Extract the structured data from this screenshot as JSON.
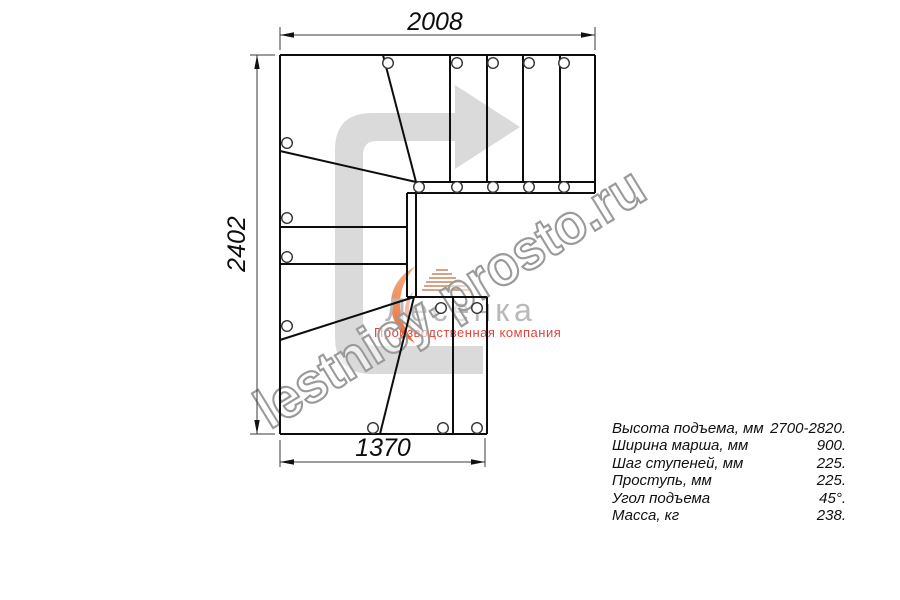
{
  "drawing": {
    "dim_top": "2008",
    "dim_left": "2402",
    "dim_bottom": "1370"
  },
  "watermark": {
    "text": "lestnicy-prosto.ru"
  },
  "logo": {
    "name": "Лесенка",
    "subtitle": "Производственная компания"
  },
  "specs": {
    "rows": [
      {
        "label": "Высота подъема, мм",
        "value": "2700-2820."
      },
      {
        "label": "Ширина марша, мм",
        "value": "900."
      },
      {
        "label": "Шаг ступеней, мм",
        "value": "225."
      },
      {
        "label": "Проступь, мм",
        "value": "225."
      },
      {
        "label": "Угол подъема",
        "value": "45°."
      },
      {
        "label": "Масса, кг",
        "value": "238."
      }
    ]
  },
  "colors": {
    "line_black": "#0d0d0d",
    "arrow_gray": "#dadada",
    "watermark_gray": "#9a9a9a",
    "logo_orange": "#ec7a42",
    "logo_red": "#e0453b",
    "logo_text_gray": "#b9b9b9"
  }
}
